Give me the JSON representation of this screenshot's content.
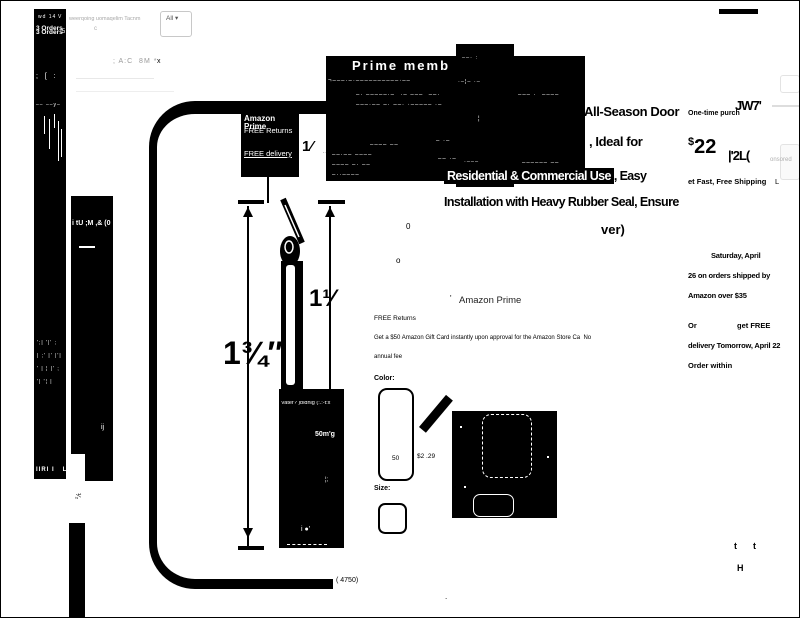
{
  "header": {
    "search_placeholder": "weerqoing uomaqelim Tacnm",
    "search_mark": "c",
    "all_label": "All ▾",
    "nav_garble": "; A:C  8M *",
    "nav_close": "x",
    "sponsored": "onsored"
  },
  "panel_a": {
    "g1": "wd 14",
    "g2": "V",
    "orders": "3 Orders",
    "g3": "' 5",
    "g4": ";  [  :",
    "g5": "–– ––y–",
    "noise": [
      "';| '|' ;",
      "| ;' |' |'|",
      "' | ¦ |' ;",
      "'| '¦ |"
    ],
    "g6": "IIRI I   L"
  },
  "panel_b": {
    "g1": "i tU ;M ,& (0",
    "g2": "ij"
  },
  "promo_box": {
    "headline": "Prime memb",
    "rows": [
      "¬–––·–·––––––––––·––",
      "–· –––––·–  ·– –––  ––·",
      "–––·–– –· ––· ·––––– ·–",
      "––– ·  ––––",
      "–––– ––",
      "– ·–",
      "––·–– ––––",
      "–––– –· ––",
      "–··––––",
      "–– ·– –",
      "–––––– ––",
      "–·––––"
    ]
  },
  "dark_block": {
    "rows": [
      "––· :",
      "·–¦– ·–",
      "¦",
      "·–––",
      "–·– ––"
    ]
  },
  "title": {
    "line1": "All-Season Door",
    "line2": ", Ideal for",
    "line3_inverse": "Residential & Commercial Use",
    "line3_rest": ", Easy",
    "line4": "Installation with Heavy Rubber Seal, Ensure",
    "line5": "ver)"
  },
  "badge_box": {
    "prime": "Amazon Prime",
    "returns": "FREE Returns",
    "delivery": "FREE delivery"
  },
  "diagram": {
    "dim_left": "1¾″",
    "dim_right": "1¹⁄",
    "dim_top": "1⁄",
    "side_mark1": "––",
    "side_mark2": "·––,",
    "stray_zero": "0",
    "stray_o": "o",
    "count": "( 4750)"
  },
  "water_box": {
    "r1": "Vater? )bldnig (:.:-t:x",
    "r2": "50m'g",
    "r3": "¦;",
    "r4": "i ●'"
  },
  "prime_section": {
    "tick": "'",
    "prime": "Amazon Prime",
    "returns": "FREE Returns",
    "gift1": "Get a $50 Amazon Gift Card instantly upon approval for the Amazon Store Ca  No",
    "gift2": "annual fee"
  },
  "options": {
    "color_label": "Color:",
    "swatch_value": "50",
    "swatch_price": "$2 .29",
    "size_label": "Size:"
  },
  "buybox": {
    "one_time": "One-time purch",
    "garble1": "JW7'",
    "price_sym": "$",
    "price_val": "22",
    "garble2": "|'2L(",
    "shipping": "et Fast, Free Shipping",
    "shipping_mark": "L"
  },
  "delivery": {
    "l1": "Saturday, April",
    "l2": "26 on orders shipped by",
    "l3": "Amazon over $35",
    "or_label": "Or",
    "get_free": "get FREE",
    "l4": "delivery Tomorrow, April 22",
    "l5": "Order within"
  },
  "footer": {
    "t1": "t",
    "t2": "t",
    "h": "H",
    "half": "¹⁄₂",
    "dot": "."
  }
}
